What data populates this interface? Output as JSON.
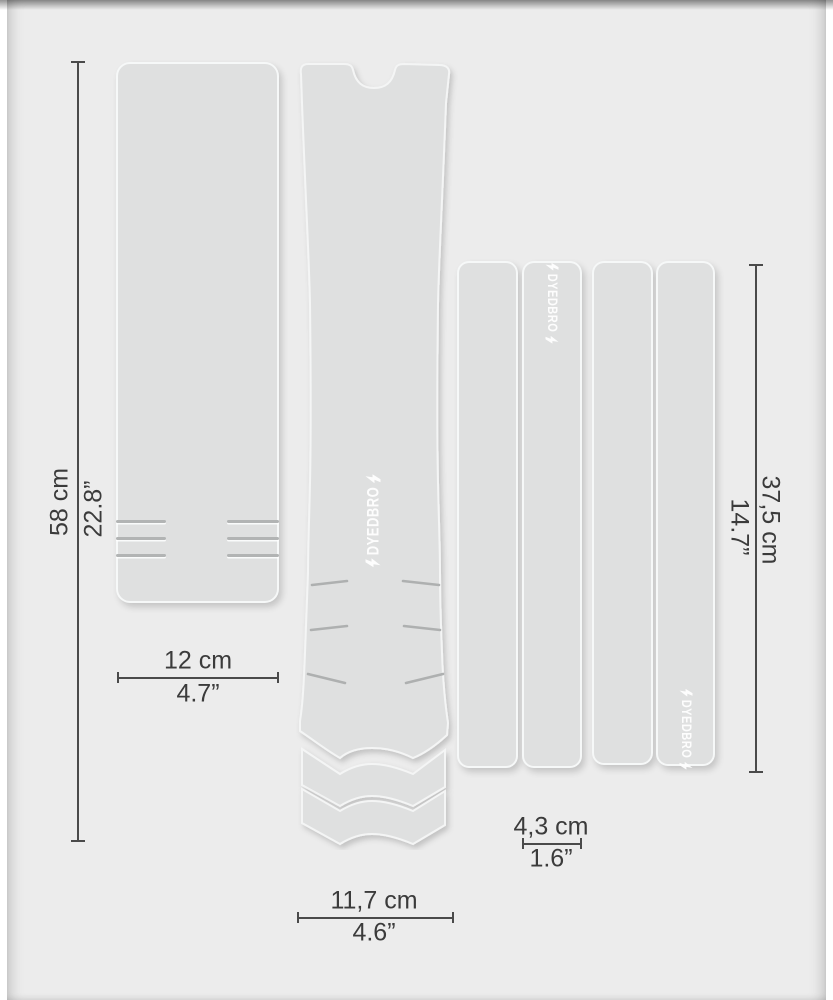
{
  "brand": {
    "logo_text": "DYEDBRO"
  },
  "dimensions": {
    "left_piece_height": {
      "cm": "58 cm",
      "inch": "22.8”"
    },
    "left_piece_width": {
      "cm": "12 cm",
      "inch": "4.7”"
    },
    "center_piece_width": {
      "cm": "11,7 cm",
      "inch": "4.6”"
    },
    "strip_width": {
      "cm": "4,3 cm",
      "inch": "1.6”"
    },
    "strip_height": {
      "cm": "37,5 cm",
      "inch": "14.7”"
    }
  },
  "colors": {
    "background": "#ececec",
    "piece_fill": "#dfe0e0",
    "piece_outline": "#f4f5f5",
    "dimension_ink": "#3b3b3b",
    "logo": "#ffffff"
  }
}
